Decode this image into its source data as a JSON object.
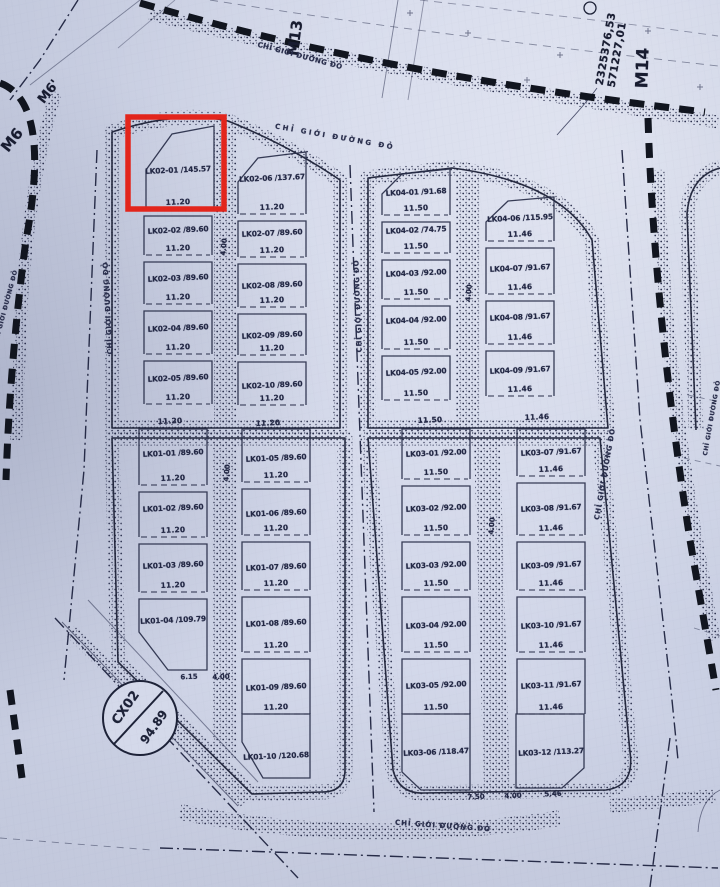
{
  "map": {
    "markers": [
      {
        "label": "M6"
      },
      {
        "label": "M6'"
      },
      {
        "label": "M13"
      },
      {
        "label": "M14"
      }
    ],
    "coordinate_label": {
      "line1": "2325376,53",
      "line2": "571227,01"
    },
    "red_line_label": "CHỈ GIỚI ĐƯỜNG ĐỎ",
    "green_space": {
      "id": "CX02",
      "area": "94.89"
    },
    "highlight": {
      "plot": "LK02-01 /145.57",
      "color": "#e3251c"
    },
    "blocks": {
      "lk02": {
        "col1": [
          {
            "id": "LK02-01 /145.57",
            "frontage": "11.20"
          },
          {
            "id": "LK02-02 /89.60",
            "frontage": "11.20"
          },
          {
            "id": "LK02-03 /89.60",
            "frontage": "11.20"
          },
          {
            "id": "LK02-04 /89.60",
            "frontage": "11.20"
          },
          {
            "id": "LK02-05 /89.60",
            "frontage": "11.20"
          }
        ],
        "col2": [
          {
            "id": "LK02-06 /137.67",
            "frontage": "11.20"
          },
          {
            "id": "LK02-07 /89.60",
            "frontage": "11.20"
          },
          {
            "id": "LK02-08 /89.60",
            "frontage": "11.20"
          },
          {
            "id": "LK02-09 /89.60",
            "frontage": "11.20"
          },
          {
            "id": "LK02-10 /89.60",
            "frontage": "11.20"
          }
        ]
      },
      "lk04": {
        "col1": [
          {
            "id": "LK04-01 /91.68",
            "frontage": "11.50"
          },
          {
            "id": "LK04-02 /74.75",
            "frontage": "11.50"
          },
          {
            "id": "LK04-03 /92.00",
            "frontage": "11.50"
          },
          {
            "id": "LK04-04 /92.00",
            "frontage": "11.50"
          },
          {
            "id": "LK04-05 /92.00",
            "frontage": "11.50"
          }
        ],
        "col2": [
          {
            "id": "LK04-06 /115.95",
            "frontage": "11.46"
          },
          {
            "id": "LK04-07 /91.67",
            "frontage": "11.46"
          },
          {
            "id": "LK04-08 /91.67",
            "frontage": "11.46"
          },
          {
            "id": "LK04-09 /91.67",
            "frontage": "11.46"
          }
        ]
      },
      "lk01": {
        "col1": [
          {
            "id": "LK01-01 /89.60",
            "frontage": "11.20"
          },
          {
            "id": "LK01-02 /89.60",
            "frontage": "11.20"
          },
          {
            "id": "LK01-03 /89.60",
            "frontage": "11.20"
          },
          {
            "id": "LK01-04 /109.79",
            "frontage": null
          }
        ],
        "col2": [
          {
            "id": "LK01-05 /89.60",
            "frontage": "11.20"
          },
          {
            "id": "LK01-06 /89.60",
            "frontage": "11.20"
          },
          {
            "id": "LK01-07 /89.60",
            "frontage": "11.20"
          },
          {
            "id": "LK01-08 /89.60",
            "frontage": "11.20"
          },
          {
            "id": "LK01-09 /89.60",
            "frontage": "11.20"
          },
          {
            "id": "LK01-10 /120.68",
            "frontage": null
          }
        ]
      },
      "lk03": {
        "col1": [
          {
            "id": "LK03-01 /92.00",
            "frontage": "11.50"
          },
          {
            "id": "LK03-02 /92.00",
            "frontage": "11.50"
          },
          {
            "id": "LK03-03 /92.00",
            "frontage": "11.50"
          },
          {
            "id": "LK03-04 /92.00",
            "frontage": "11.50"
          },
          {
            "id": "LK03-05 /92.00",
            "frontage": "11.50"
          },
          {
            "id": "LK03-06 /118.47",
            "frontage": null
          }
        ],
        "col2": [
          {
            "id": "LK03-07 /91.67",
            "frontage": "11.46"
          },
          {
            "id": "LK03-08 /91.67",
            "frontage": "11.46"
          },
          {
            "id": "LK03-09 /91.67",
            "frontage": "11.46"
          },
          {
            "id": "LK03-10 /91.67",
            "frontage": "11.46"
          },
          {
            "id": "LK03-11 /91.67",
            "frontage": "11.46"
          },
          {
            "id": "LK03-12 /113.27",
            "frontage": null
          }
        ]
      }
    },
    "back_dims": [
      "11.20",
      "11.20",
      "11.50",
      "11.46"
    ],
    "edge_dims": [
      "6.15",
      "4.00",
      "7.50",
      "4.00",
      "5.46"
    ],
    "alley_dim": "4.00",
    "colors": {
      "paper": "#d0d5e7",
      "ink": "#262b45",
      "heavy_line": "#131722",
      "highlight": "#e3251c"
    }
  }
}
